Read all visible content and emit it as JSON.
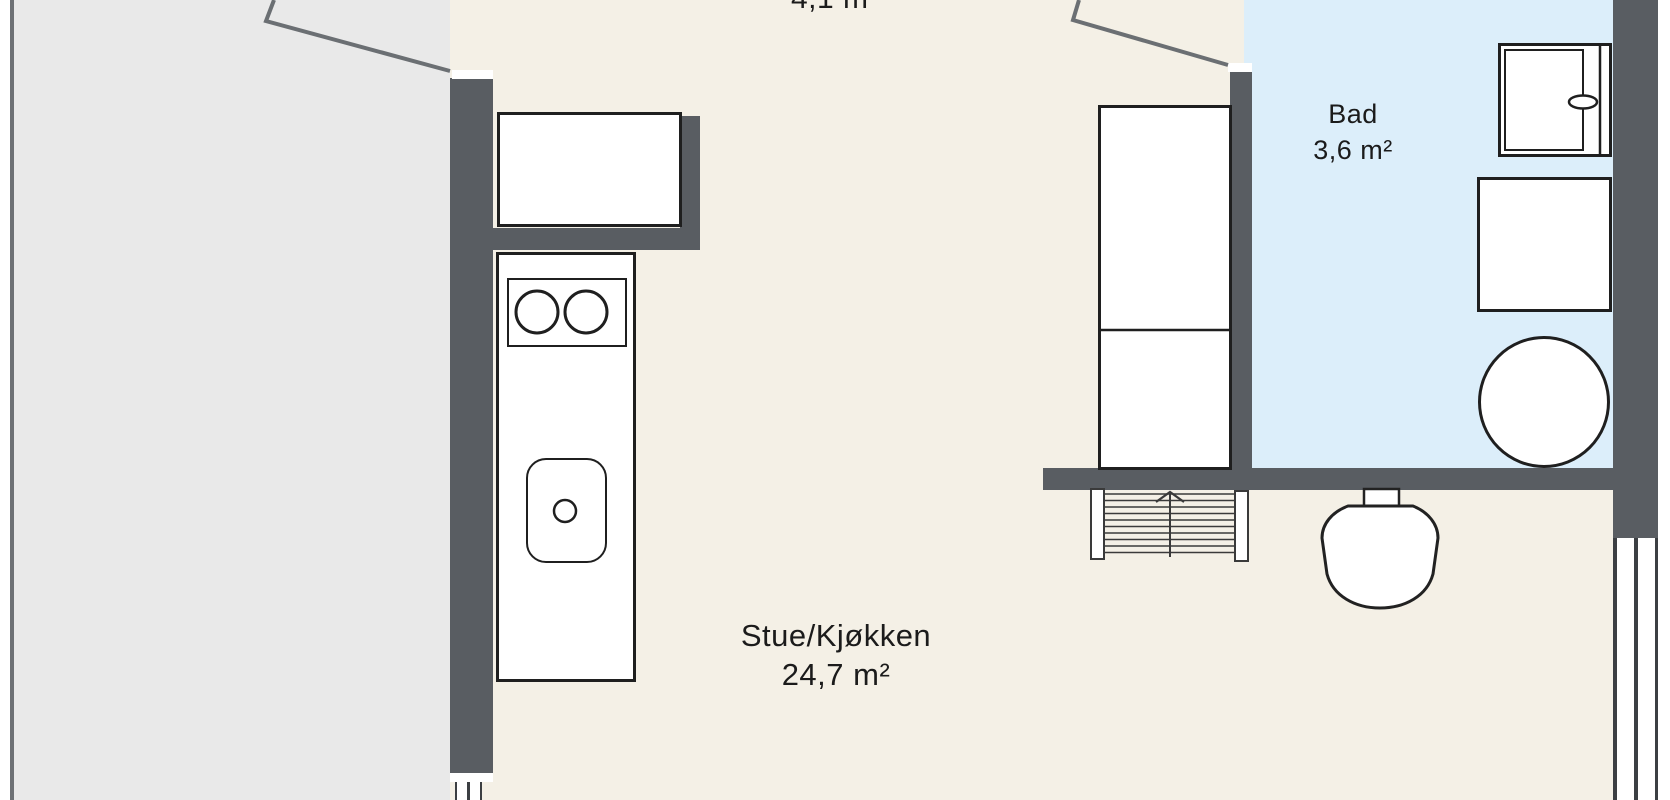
{
  "plan_title": "apartment floor plan",
  "rooms": {
    "hall": {
      "area": "4,1 m²"
    },
    "bathroom": {
      "name": "Bad",
      "area": "3,6 m²"
    },
    "living": {
      "name": "Stue/Kjøkken",
      "area": "24,7 m²"
    }
  },
  "colors": {
    "background": "#ffffff",
    "floor_interior": "#f4f0e6",
    "floor_bathroom": "#dceefa",
    "floor_balcony": "#e9e9e9",
    "wall": "#595d62",
    "door_line": "#6b6f73",
    "line": "#222222",
    "text": "#1b1b1b"
  },
  "fixtures": [
    "balcony-door",
    "bathroom-door",
    "kitchen-upper-cabinet",
    "kitchen-counter",
    "cooktop",
    "kitchen-sink",
    "wardrobe",
    "stairs-up",
    "toilet",
    "shower-cabinet",
    "washing-machine",
    "round-basin",
    "window-bottom-left",
    "window-right"
  ]
}
